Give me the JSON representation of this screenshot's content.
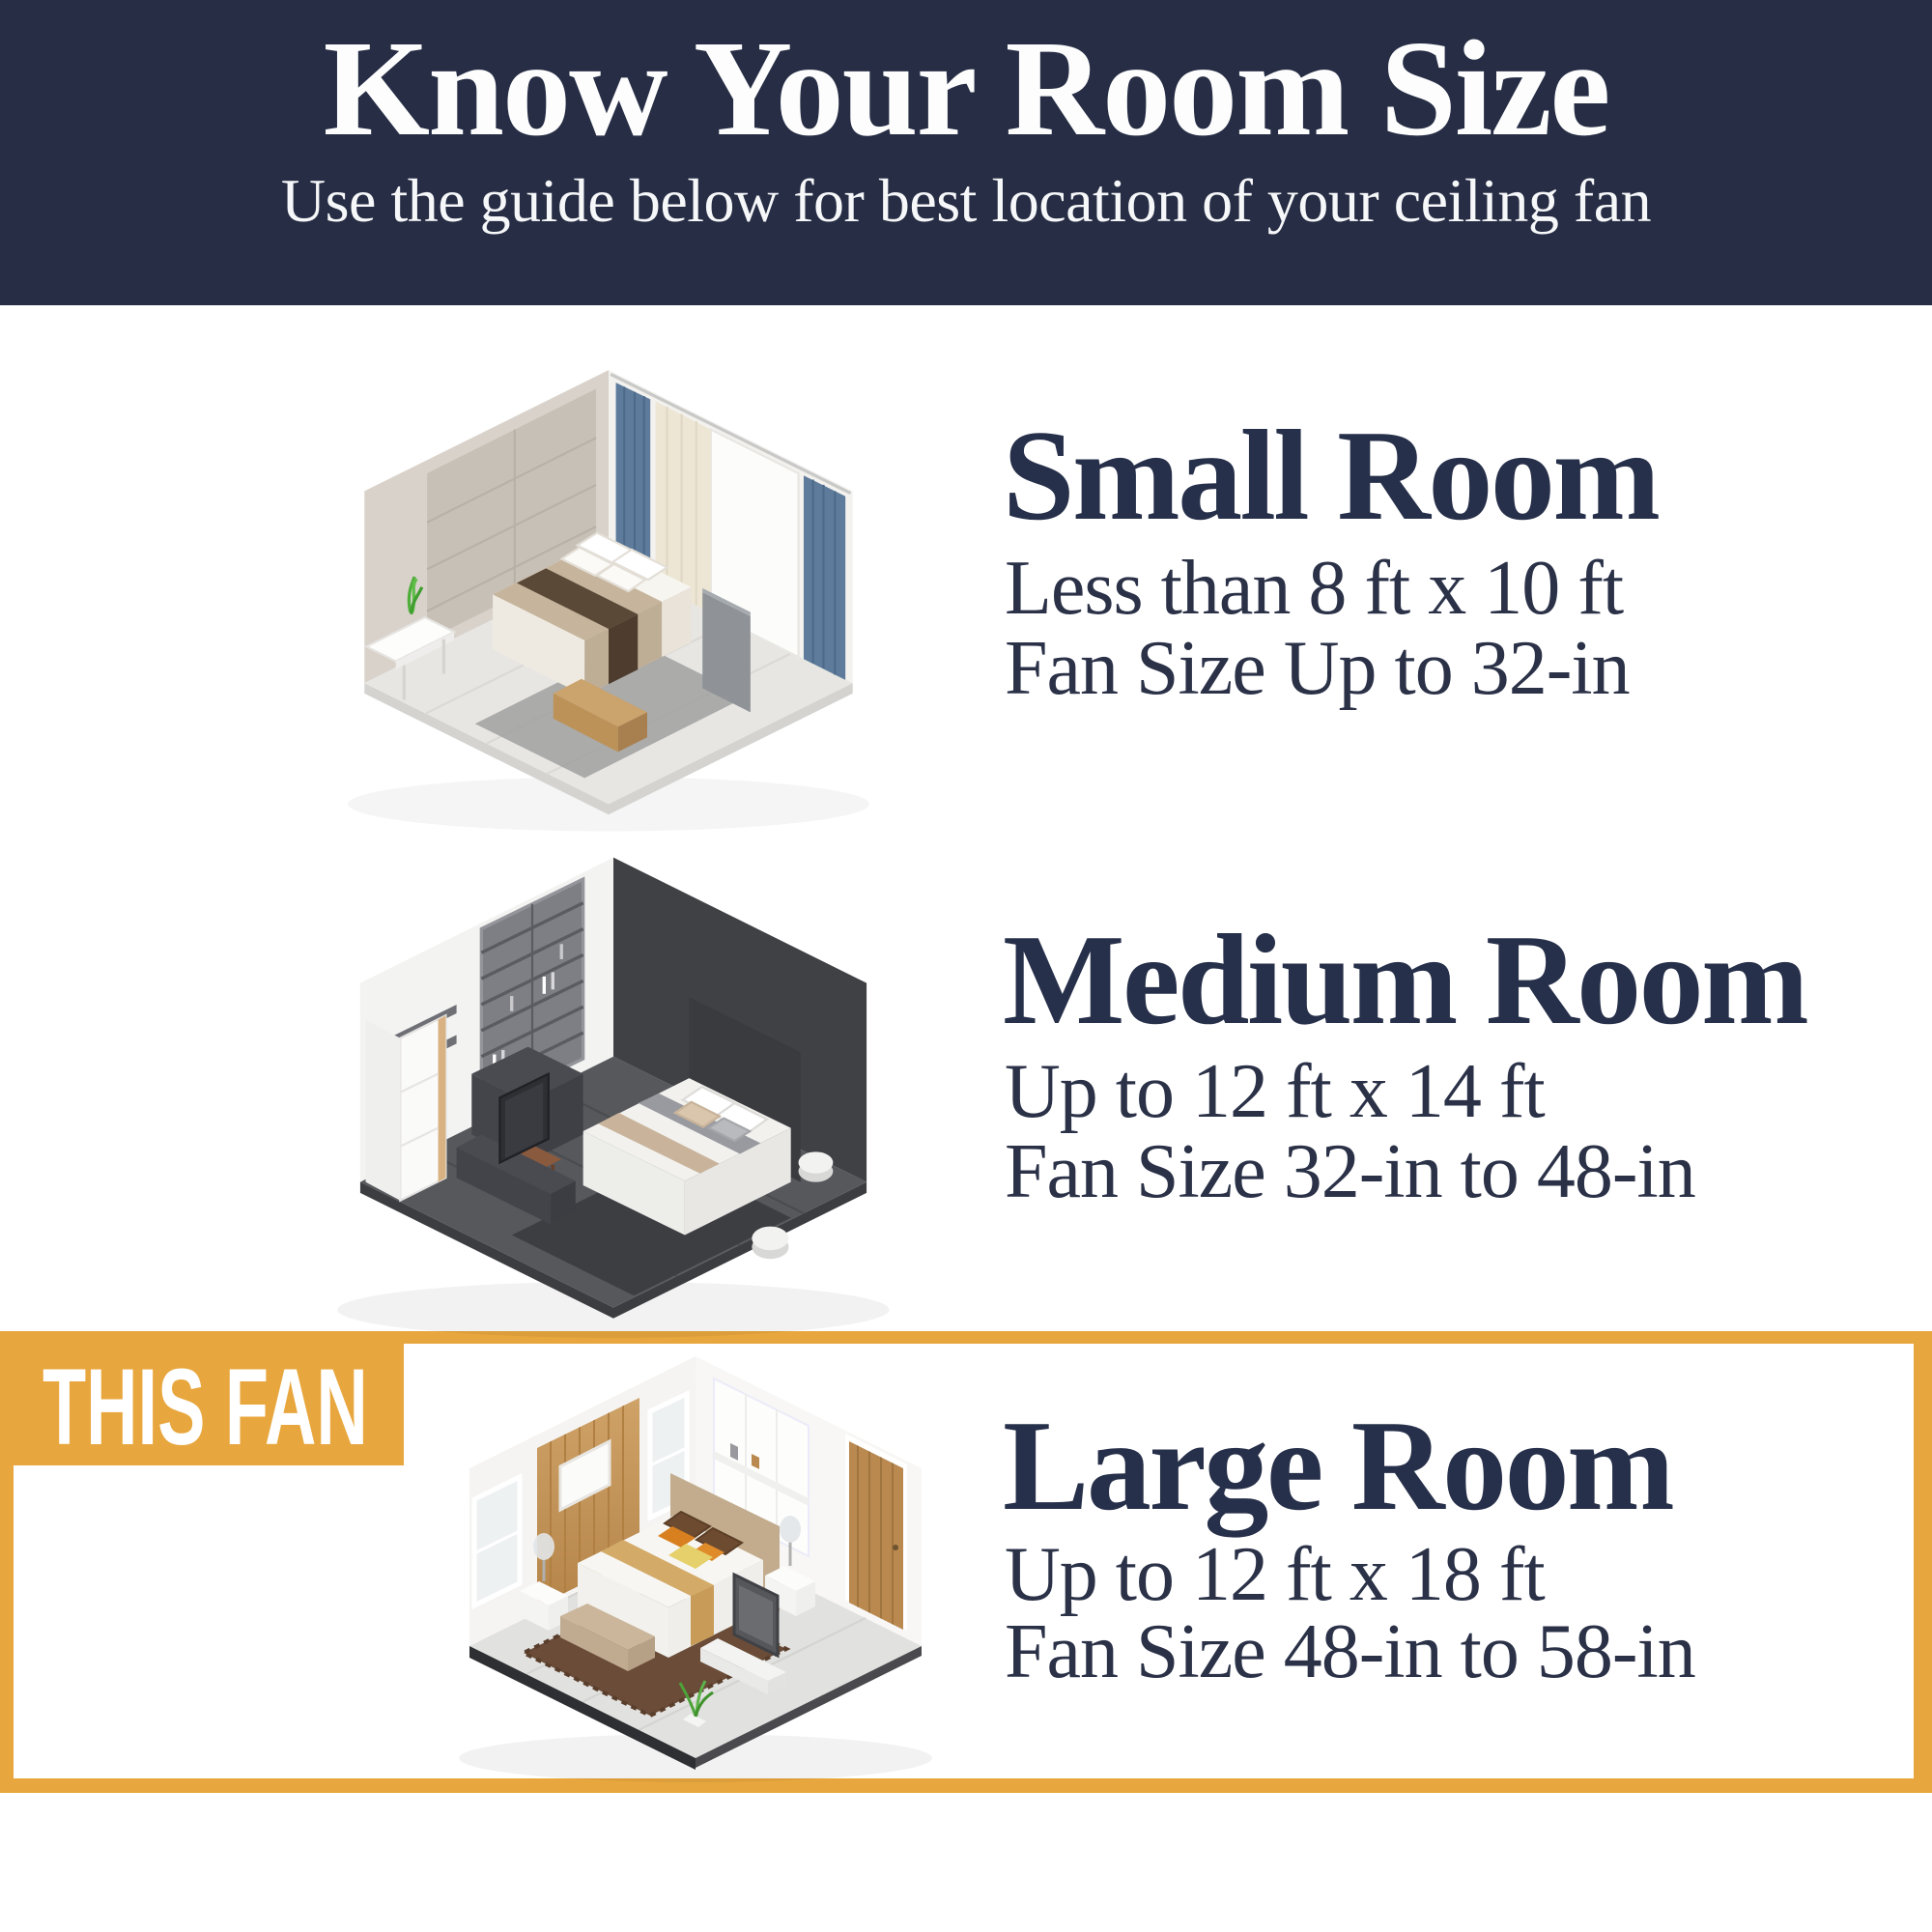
{
  "colors": {
    "navy": "#262D44",
    "gold": "#E8A73E",
    "ink": "#27304A",
    "ink2": "#2B3248",
    "white": "#FFFFFF"
  },
  "header": {
    "title": "Know Your Room Size",
    "subtitle": "Use the guide below for best location of your ceiling fan"
  },
  "sections": [
    {
      "id": "small",
      "heading": "Small Room",
      "size_line": "Less than 8 ft x 10 ft",
      "fan_line": "Fan Size Up to 32-in",
      "illustration": "isometric-small-bedroom"
    },
    {
      "id": "medium",
      "heading": "Medium Room",
      "size_line": "Up to 12 ft x 14 ft",
      "fan_line": "Fan Size 32-in to 48-in",
      "illustration": "isometric-medium-bedroom"
    },
    {
      "id": "large",
      "heading": "Large Room",
      "size_line": "Up to 12 ft x 18 ft",
      "fan_line": "Fan Size 48-in to 58-in",
      "badge": "THIS FAN",
      "highlighted": true,
      "illustration": "isometric-large-bedroom"
    }
  ]
}
